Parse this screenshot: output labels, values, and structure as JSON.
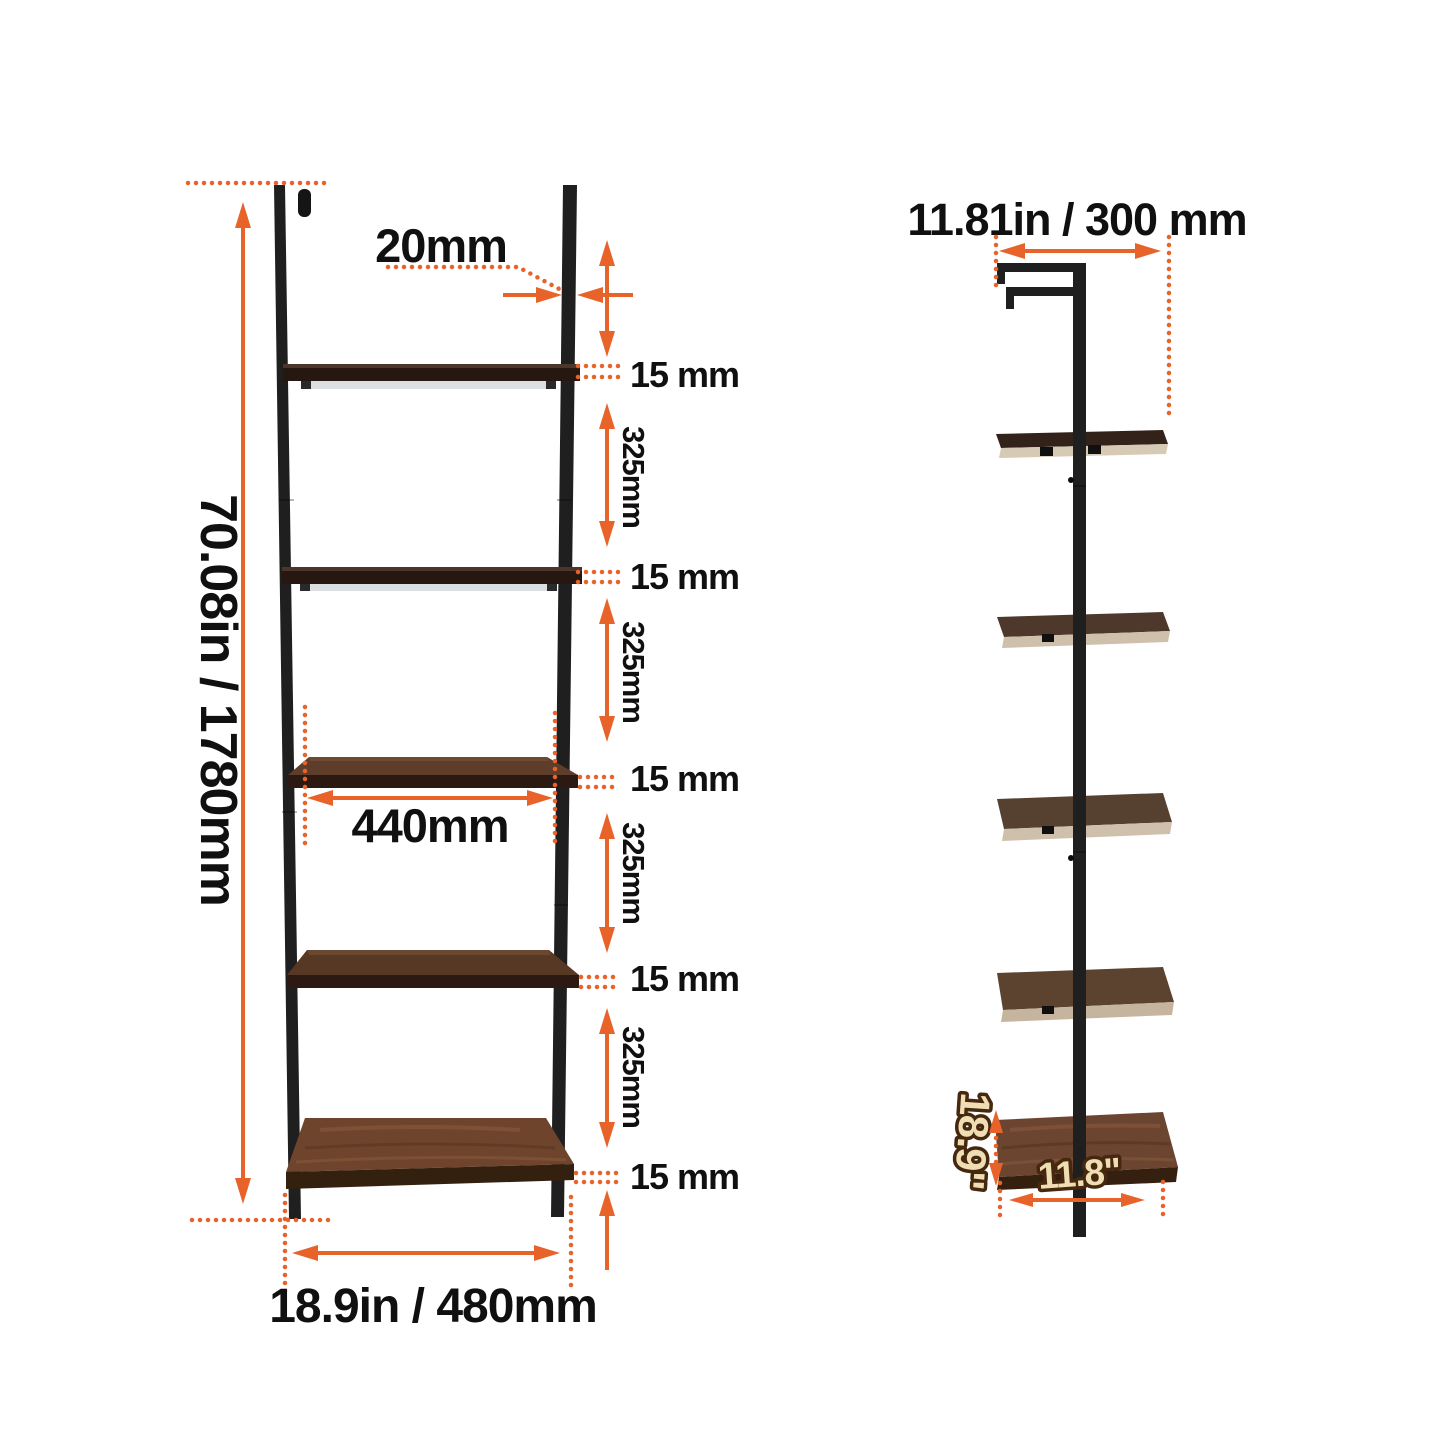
{
  "page": {
    "description": "Wall-mounted 5-tier ladder shelf dimension diagram, front view and side view",
    "background": "#FFFFFF"
  },
  "colors": {
    "accent": "#E8632A",
    "label_text": "#101010",
    "cream_fill": "#EFDDB3",
    "cream_outline": "#46280F",
    "rail_black": "#1F1F1F",
    "wood_top_dark": "#4C352A",
    "wood_face_dark": "#261711",
    "wood_mid": "#5E3D2A",
    "wood_bottom": "#6E452C",
    "side_edge_tan": "#D7CAB5"
  },
  "front_view": {
    "name": "front view with dimensions",
    "overall_height_label": "70.08in / 1780mm",
    "frame_tube_label": "20mm",
    "shelf_span_label": "440mm",
    "overall_width_label": "18.9in / 480mm",
    "thickness_labels": [
      "15 mm",
      "15 mm",
      "15 mm",
      "15 mm",
      "15 mm"
    ],
    "spacing_labels": [
      "325mm",
      "325mm",
      "325mm",
      "325mm"
    ]
  },
  "side_view": {
    "name": "side view with dimensions",
    "depth_label": "11.81in / 300 mm",
    "shelf_depth_label": "18.9\"",
    "shelf_front_label": "11.8\""
  }
}
